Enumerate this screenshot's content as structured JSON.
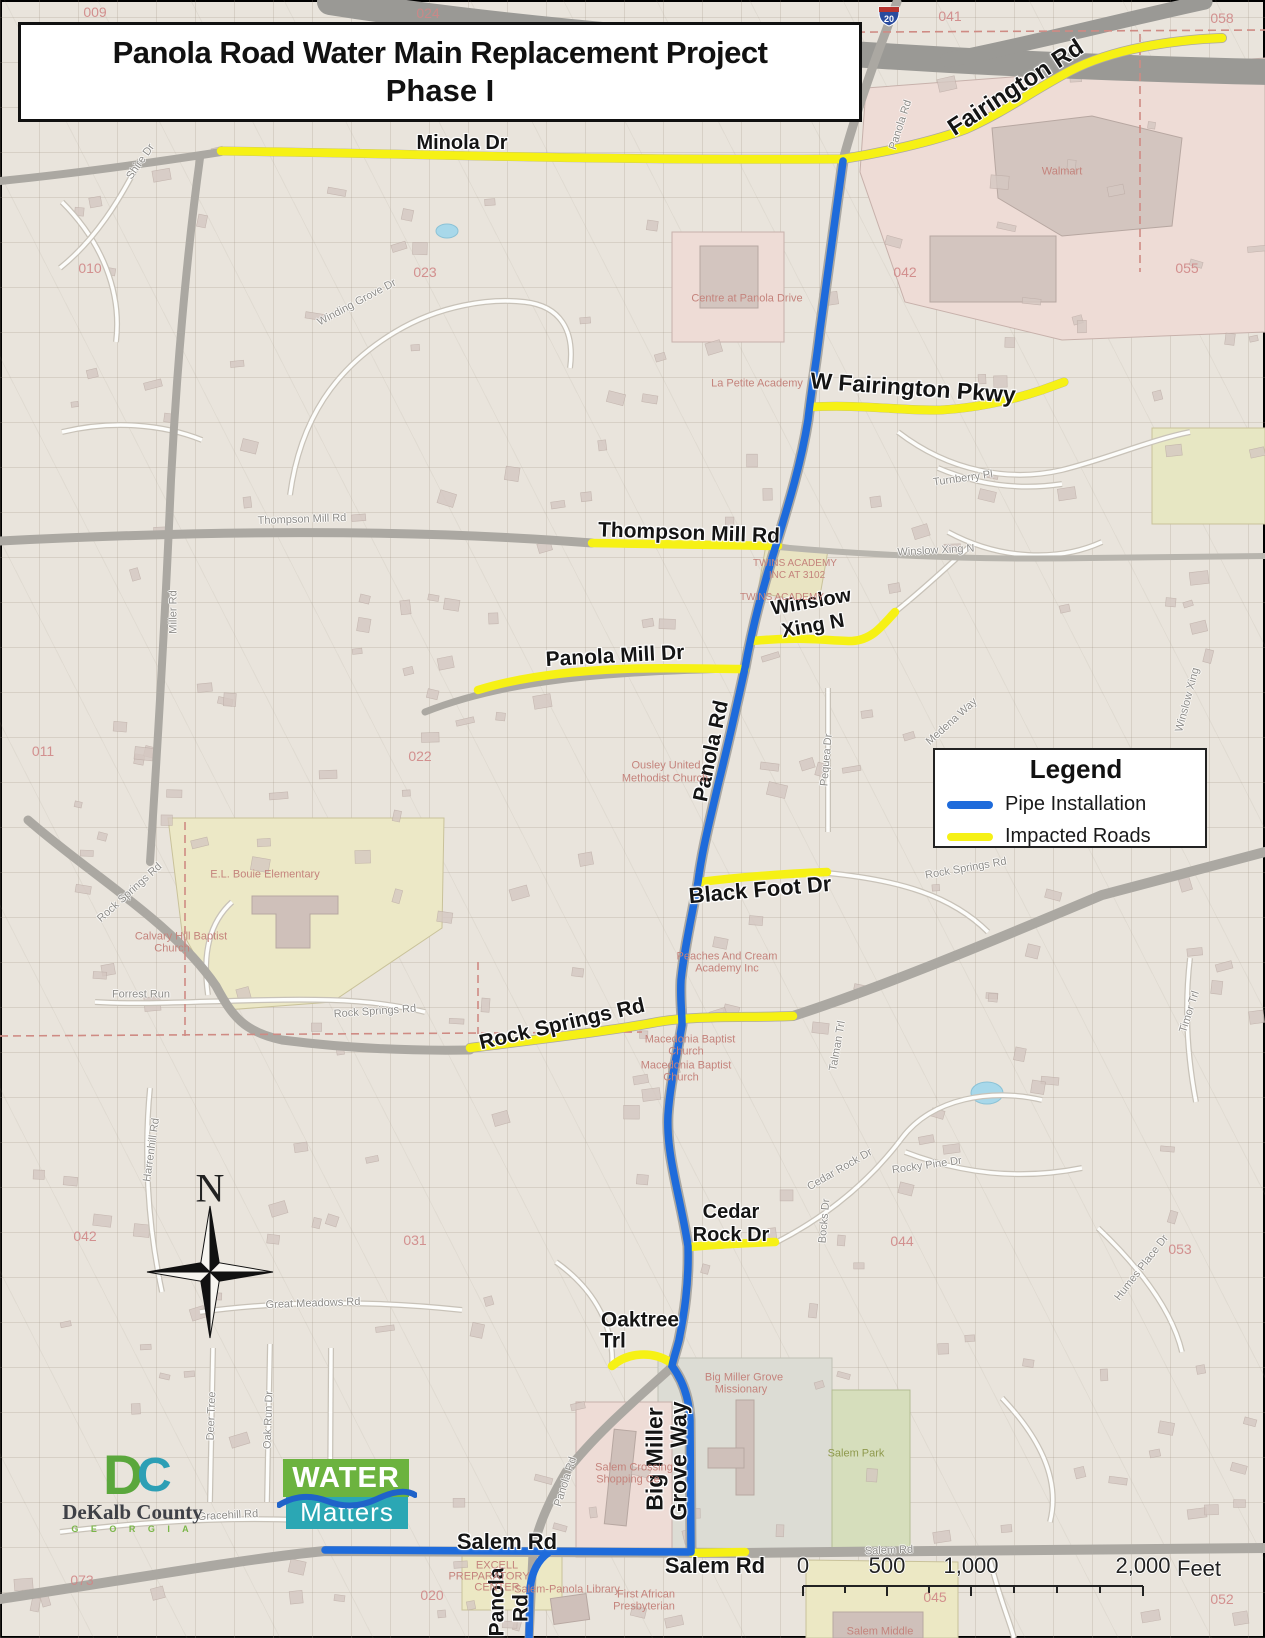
{
  "title": {
    "line1": "Panola Road Water Main Replacement Project",
    "line2": "Phase I"
  },
  "legend": {
    "title": "Legend",
    "items": [
      {
        "label": "Pipe Installation",
        "color": "#1e6bdb"
      },
      {
        "label": "Impacted Roads",
        "color": "#f6f115"
      }
    ]
  },
  "north_arrow": {
    "label": "N"
  },
  "scale_bar": {
    "ticks": [
      "0",
      "500",
      "1,000",
      "2,000"
    ],
    "unit": "Feet"
  },
  "interstate_shield": {
    "number": "20"
  },
  "logos": {
    "dekalb": {
      "d": "D",
      "c": "C",
      "name": "DeKalb County",
      "subtitle": "G E O R G I A"
    },
    "water_matters": {
      "line1": "WATER",
      "line2": "Matters"
    }
  },
  "colors": {
    "pipe_installation": "#1e6bdb",
    "impacted_roads": "#f6f115",
    "major_road": "#aba8a2",
    "freeway": "#9a9995",
    "background": "#e9e4dc"
  },
  "map_labels": [
    {
      "t": "Minola Dr",
      "x": 462,
      "y": 143,
      "r": 0,
      "s": 20,
      "c": "b"
    },
    {
      "t": "Fairington Rd",
      "x": 1016,
      "y": 88,
      "r": -33,
      "s": 24,
      "c": "b"
    },
    {
      "t": "W Fairington Pkwy",
      "x": 913,
      "y": 388,
      "r": 4,
      "s": 23,
      "c": "b"
    },
    {
      "t": "Thompson Mill Rd",
      "x": 689,
      "y": 533,
      "r": 2,
      "s": 21,
      "c": "b"
    },
    {
      "t": "Winslow",
      "x": 811,
      "y": 602,
      "r": -10,
      "s": 20,
      "c": "b"
    },
    {
      "t": "Xing N",
      "x": 813,
      "y": 626,
      "r": -10,
      "s": 20,
      "c": "b"
    },
    {
      "t": "Panola Mill Dr",
      "x": 615,
      "y": 656,
      "r": -3,
      "s": 21,
      "c": "b"
    },
    {
      "t": "Panola Rd",
      "x": 711,
      "y": 751,
      "r": -78,
      "s": 21,
      "c": "b"
    },
    {
      "t": "Black Foot Dr",
      "x": 760,
      "y": 890,
      "r": -5,
      "s": 22,
      "c": "b"
    },
    {
      "t": "Rock Springs Rd",
      "x": 562,
      "y": 1024,
      "r": -13,
      "s": 21,
      "c": "b"
    },
    {
      "t": "Cedar",
      "x": 731,
      "y": 1212,
      "r": 0,
      "s": 20,
      "c": "b"
    },
    {
      "t": "Rock Dr",
      "x": 731,
      "y": 1235,
      "r": 0,
      "s": 20,
      "c": "b"
    },
    {
      "t": "Oaktree",
      "x": 640,
      "y": 1320,
      "r": 0,
      "s": 21,
      "c": "b"
    },
    {
      "t": "Trl",
      "x": 613,
      "y": 1341,
      "r": 0,
      "s": 21,
      "c": "b"
    },
    {
      "t": "Big Miller",
      "x": 655,
      "y": 1459,
      "r": -90,
      "s": 23,
      "c": "b"
    },
    {
      "t": "Grove Way",
      "x": 679,
      "y": 1461,
      "r": -90,
      "s": 23,
      "c": "b"
    },
    {
      "t": "Salem Rd",
      "x": 507,
      "y": 1542,
      "r": 0,
      "s": 22,
      "c": "b"
    },
    {
      "t": "Salem Rd",
      "x": 715,
      "y": 1566,
      "r": 0,
      "s": 22,
      "c": "b"
    },
    {
      "t": "Panola",
      "x": 497,
      "y": 1602,
      "r": -90,
      "s": 21,
      "c": "b"
    },
    {
      "t": "Rd",
      "x": 521,
      "y": 1608,
      "r": -90,
      "s": 21,
      "c": "b"
    },
    {
      "t": "Shire Dr",
      "x": 141,
      "y": 162,
      "r": -55,
      "s": 11,
      "c": "g"
    },
    {
      "t": "Panola Rd",
      "x": 901,
      "y": 125,
      "r": -72,
      "s": 11,
      "c": "g"
    },
    {
      "t": "Winding Grove Dr",
      "x": 357,
      "y": 303,
      "r": -28,
      "s": 11,
      "c": "g"
    },
    {
      "t": "Thompson Mill Rd",
      "x": 302,
      "y": 520,
      "r": -2,
      "s": 11,
      "c": "g"
    },
    {
      "t": "Winslow Xing N",
      "x": 936,
      "y": 551,
      "r": -3,
      "s": 11,
      "c": "g"
    },
    {
      "t": "Miller Rd",
      "x": 174,
      "y": 612,
      "r": -90,
      "s": 11,
      "c": "g"
    },
    {
      "t": "Turnberry Pl",
      "x": 963,
      "y": 479,
      "r": -8,
      "s": 11,
      "c": "g"
    },
    {
      "t": "Medena Way",
      "x": 952,
      "y": 722,
      "r": -42,
      "s": 11,
      "c": "g"
    },
    {
      "t": "Pequea Dr",
      "x": 827,
      "y": 760,
      "r": -85,
      "s": 11,
      "c": "g"
    },
    {
      "t": "Winslow Xing",
      "x": 1188,
      "y": 700,
      "r": -75,
      "s": 11,
      "c": "g"
    },
    {
      "t": "Rock Springs Rd",
      "x": 966,
      "y": 869,
      "r": -10,
      "s": 11,
      "c": "g"
    },
    {
      "t": "Rock Springs Rd",
      "x": 130,
      "y": 893,
      "r": -42,
      "s": 11,
      "c": "g"
    },
    {
      "t": "Rock Springs Rd",
      "x": 375,
      "y": 1012,
      "r": -4,
      "s": 11,
      "c": "g"
    },
    {
      "t": "Forrest Run",
      "x": 141,
      "y": 995,
      "r": 0,
      "s": 11,
      "c": "g"
    },
    {
      "t": "Timor Trl",
      "x": 1190,
      "y": 1012,
      "r": -72,
      "s": 11,
      "c": "g"
    },
    {
      "t": "Talman Trl",
      "x": 838,
      "y": 1046,
      "r": -80,
      "s": 11,
      "c": "g"
    },
    {
      "t": "Cedar Rock Dr",
      "x": 840,
      "y": 1170,
      "r": -30,
      "s": 11,
      "c": "g"
    },
    {
      "t": "Rocky Pine Dr",
      "x": 927,
      "y": 1166,
      "r": -8,
      "s": 11,
      "c": "g"
    },
    {
      "t": "Bocks Dr",
      "x": 825,
      "y": 1221,
      "r": -85,
      "s": 11,
      "c": "g"
    },
    {
      "t": "Humes Place Dr",
      "x": 1142,
      "y": 1268,
      "r": -52,
      "s": 11,
      "c": "g"
    },
    {
      "t": "Great Meadows Rd",
      "x": 313,
      "y": 1304,
      "r": -2,
      "s": 11,
      "c": "g"
    },
    {
      "t": "Harrenhill Rd",
      "x": 152,
      "y": 1150,
      "r": -82,
      "s": 11,
      "c": "g"
    },
    {
      "t": "Deer Tree",
      "x": 212,
      "y": 1416,
      "r": -88,
      "s": 11,
      "c": "g"
    },
    {
      "t": "Oak Run Dr",
      "x": 269,
      "y": 1420,
      "r": -88,
      "s": 11,
      "c": "g"
    },
    {
      "t": "Gracehill Rd",
      "x": 228,
      "y": 1516,
      "r": -3,
      "s": 11,
      "c": "g"
    },
    {
      "t": "Panola Rd",
      "x": 566,
      "y": 1482,
      "r": -72,
      "s": 11,
      "c": "g"
    },
    {
      "t": "Salem Rd",
      "x": 889,
      "y": 1551,
      "r": -2,
      "s": 11,
      "c": "g"
    },
    {
      "t": "Walmart",
      "x": 1062,
      "y": 172,
      "r": 0,
      "s": 11,
      "c": "p"
    },
    {
      "t": "Centre at Panola Drive",
      "x": 747,
      "y": 299,
      "r": 0,
      "s": 11,
      "c": "p"
    },
    {
      "t": "La Petite Academy",
      "x": 757,
      "y": 384,
      "r": 0,
      "s": 11,
      "c": "p"
    },
    {
      "t": "TWINS ACADEMY",
      "x": 795,
      "y": 564,
      "r": 0,
      "s": 10,
      "c": "p"
    },
    {
      "t": "INC AT 3102",
      "x": 797,
      "y": 576,
      "r": 0,
      "s": 10,
      "c": "p"
    },
    {
      "t": "TWINS ACADEMY",
      "x": 782,
      "y": 598,
      "r": 0,
      "s": 10,
      "c": "p"
    },
    {
      "t": "Ousley United",
      "x": 666,
      "y": 766,
      "r": 0,
      "s": 11,
      "c": "p"
    },
    {
      "t": "Methodist Church",
      "x": 665,
      "y": 779,
      "r": 0,
      "s": 11,
      "c": "p"
    },
    {
      "t": "E.L. Bouie Elementary",
      "x": 265,
      "y": 875,
      "r": 0,
      "s": 11,
      "c": "p"
    },
    {
      "t": "Calvary Hill Baptist",
      "x": 181,
      "y": 937,
      "r": 0,
      "s": 11,
      "c": "p"
    },
    {
      "t": "Church",
      "x": 172,
      "y": 949,
      "r": 0,
      "s": 11,
      "c": "p"
    },
    {
      "t": "Peaches And Cream",
      "x": 727,
      "y": 957,
      "r": 0,
      "s": 11,
      "c": "p"
    },
    {
      "t": "Academy Inc",
      "x": 727,
      "y": 969,
      "r": 0,
      "s": 11,
      "c": "p"
    },
    {
      "t": "Macedonia Baptist",
      "x": 690,
      "y": 1040,
      "r": 0,
      "s": 11,
      "c": "p"
    },
    {
      "t": "Church",
      "x": 686,
      "y": 1052,
      "r": 0,
      "s": 11,
      "c": "p"
    },
    {
      "t": "Macedonia Baptist",
      "x": 686,
      "y": 1066,
      "r": 0,
      "s": 11,
      "c": "p"
    },
    {
      "t": "Church",
      "x": 681,
      "y": 1078,
      "r": 0,
      "s": 11,
      "c": "p"
    },
    {
      "t": "Big Miller Grove",
      "x": 744,
      "y": 1378,
      "r": 0,
      "s": 11,
      "c": "p"
    },
    {
      "t": "Missionary",
      "x": 741,
      "y": 1390,
      "r": 0,
      "s": 11,
      "c": "p"
    },
    {
      "t": "Salem Crossing",
      "x": 634,
      "y": 1468,
      "r": 0,
      "s": 11,
      "c": "p"
    },
    {
      "t": "Shopping Ce",
      "x": 628,
      "y": 1480,
      "r": 0,
      "s": 11,
      "c": "p"
    },
    {
      "t": "EXCELL",
      "x": 497,
      "y": 1566,
      "r": 0,
      "s": 11,
      "c": "p"
    },
    {
      "t": "PREPARATORY",
      "x": 489,
      "y": 1577,
      "r": 0,
      "s": 11,
      "c": "p"
    },
    {
      "t": "CENTER",
      "x": 497,
      "y": 1588,
      "r": 0,
      "s": 11,
      "c": "p"
    },
    {
      "t": "Salem-Panola Library",
      "x": 567,
      "y": 1590,
      "r": 0,
      "s": 11,
      "c": "p"
    },
    {
      "t": "First African",
      "x": 646,
      "y": 1595,
      "r": 0,
      "s": 11,
      "c": "p"
    },
    {
      "t": "Presbyterian",
      "x": 644,
      "y": 1607,
      "r": 0,
      "s": 11,
      "c": "p"
    },
    {
      "t": "Salem Middle",
      "x": 880,
      "y": 1632,
      "r": 0,
      "s": 11,
      "c": "p"
    },
    {
      "t": "Salem Park",
      "x": 856,
      "y": 1454,
      "r": 0,
      "s": 11,
      "c": "k"
    },
    {
      "t": "009",
      "x": 95,
      "y": 12,
      "r": 0,
      "s": 14,
      "c": "r"
    },
    {
      "t": "024",
      "x": 428,
      "y": 13,
      "r": 0,
      "s": 14,
      "c": "r"
    },
    {
      "t": "041",
      "x": 950,
      "y": 16,
      "r": 0,
      "s": 14,
      "c": "r"
    },
    {
      "t": "058",
      "x": 1222,
      "y": 18,
      "r": 0,
      "s": 14,
      "c": "r"
    },
    {
      "t": "010",
      "x": 90,
      "y": 268,
      "r": 0,
      "s": 14,
      "c": "r"
    },
    {
      "t": "023",
      "x": 425,
      "y": 272,
      "r": 0,
      "s": 14,
      "c": "r"
    },
    {
      "t": "042",
      "x": 905,
      "y": 272,
      "r": 0,
      "s": 14,
      "c": "r"
    },
    {
      "t": "055",
      "x": 1187,
      "y": 268,
      "r": 0,
      "s": 14,
      "c": "r"
    },
    {
      "t": "011",
      "x": 43,
      "y": 751,
      "r": 0,
      "s": 14,
      "c": "r"
    },
    {
      "t": "022",
      "x": 420,
      "y": 756,
      "r": 0,
      "s": 14,
      "c": "r"
    },
    {
      "t": "054",
      "x": 1180,
      "y": 761,
      "r": 0,
      "s": 14,
      "c": "r"
    },
    {
      "t": "042",
      "x": 85,
      "y": 1236,
      "r": 0,
      "s": 14,
      "c": "r"
    },
    {
      "t": "031",
      "x": 415,
      "y": 1240,
      "r": 0,
      "s": 14,
      "c": "r"
    },
    {
      "t": "044",
      "x": 902,
      "y": 1241,
      "r": 0,
      "s": 14,
      "c": "r"
    },
    {
      "t": "053",
      "x": 1180,
      "y": 1249,
      "r": 0,
      "s": 14,
      "c": "r"
    },
    {
      "t": "073",
      "x": 82,
      "y": 1580,
      "r": 0,
      "s": 14,
      "c": "r"
    },
    {
      "t": "020",
      "x": 432,
      "y": 1595,
      "r": 0,
      "s": 14,
      "c": "r"
    },
    {
      "t": "045",
      "x": 935,
      "y": 1597,
      "r": 0,
      "s": 14,
      "c": "r"
    },
    {
      "t": "052",
      "x": 1222,
      "y": 1599,
      "r": 0,
      "s": 14,
      "c": "r"
    }
  ]
}
